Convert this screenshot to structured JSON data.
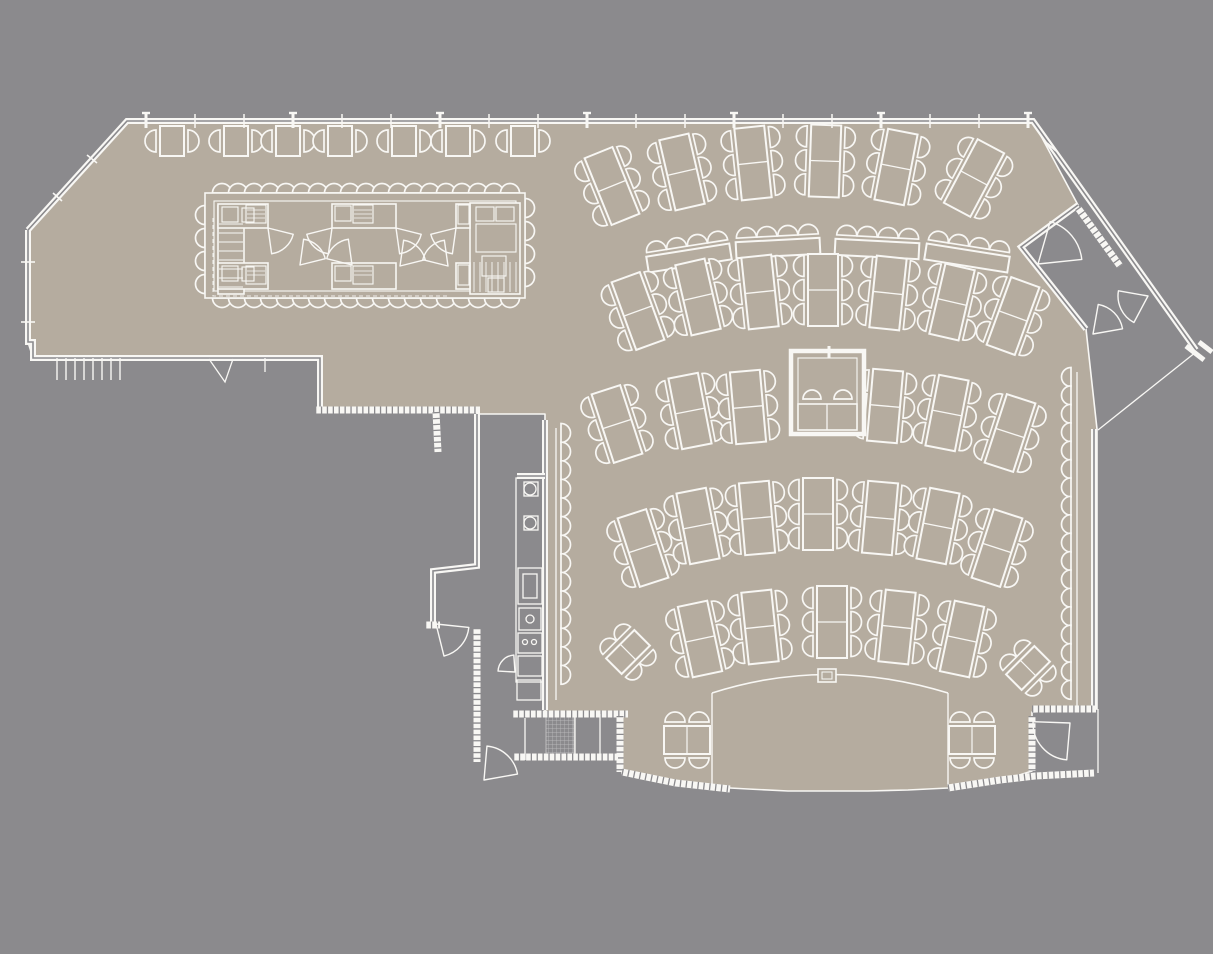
{
  "meta": {
    "type": "architectural-floor-plan",
    "description": "restaurant banquet floor plan, white linework on gray with taupe floor"
  },
  "colors": {
    "background": "#8b8a8d",
    "floor": "#b5ac9f",
    "line": "#f8f7f4",
    "line_soft": "#eeede9"
  },
  "canvas": {
    "width": 1213,
    "height": 954
  },
  "floor_outline": [
    [
      127,
      121
    ],
    [
      1033,
      121
    ],
    [
      1078,
      205
    ],
    [
      1021,
      247
    ],
    [
      1086,
      329
    ],
    [
      1097,
      429
    ],
    [
      1097,
      709
    ],
    [
      1032,
      712
    ],
    [
      1032,
      771
    ],
    [
      1010,
      778
    ],
    [
      980,
      784
    ],
    [
      948,
      788
    ],
    [
      908,
      790
    ],
    [
      868,
      791
    ],
    [
      827,
      791
    ],
    [
      788,
      791
    ],
    [
      748,
      789
    ],
    [
      712,
      787
    ],
    [
      678,
      783
    ],
    [
      648,
      779
    ],
    [
      622,
      774
    ],
    [
      622,
      712
    ],
    [
      545,
      712
    ],
    [
      545,
      414
    ],
    [
      477,
      414
    ],
    [
      477,
      410
    ],
    [
      320,
      409
    ],
    [
      320,
      358
    ],
    [
      33,
      358
    ],
    [
      28,
      342
    ],
    [
      28,
      230
    ]
  ],
  "walls": {
    "double": [
      [
        [
          28,
          230
        ],
        [
          127,
          121
        ],
        [
          1033,
          121
        ],
        [
          1196,
          350
        ]
      ],
      [
        [
          28,
          230
        ],
        [
          28,
          342
        ],
        [
          33,
          342
        ],
        [
          33,
          358
        ],
        [
          320,
          358
        ],
        [
          320,
          409
        ]
      ],
      [
        [
          477,
          414
        ],
        [
          477,
          566
        ],
        [
          433,
          571
        ],
        [
          433,
          622
        ]
      ],
      [
        [
          545,
          420
        ],
        [
          545,
          710
        ]
      ],
      [
        [
          1094,
          429
        ],
        [
          1094,
          709
        ]
      ],
      [
        [
          1078,
          205
        ],
        [
          1021,
          247
        ],
        [
          1086,
          329
        ]
      ],
      [
        [
          517,
          476
        ],
        [
          545,
          476
        ]
      ]
    ],
    "hatched": [
      [
        [
          315,
          410
        ],
        [
          480,
          410
        ]
      ],
      [
        [
          436,
          412
        ],
        [
          438,
          452
        ]
      ],
      [
        [
          477,
          628
        ],
        [
          477,
          762
        ]
      ],
      [
        [
          425,
          625
        ],
        [
          440,
          625
        ]
      ],
      [
        [
          512,
          714
        ],
        [
          628,
          714
        ]
      ],
      [
        [
          620,
          716
        ],
        [
          620,
          772
        ]
      ],
      [
        [
          622,
          772
        ],
        [
          676,
          783
        ],
        [
          730,
          789
        ]
      ],
      [
        [
          948,
          788
        ],
        [
          1000,
          780
        ],
        [
          1035,
          776
        ],
        [
          1094,
          773
        ]
      ],
      [
        [
          1032,
          709
        ],
        [
          1096,
          709
        ]
      ],
      [
        [
          1032,
          716
        ],
        [
          1032,
          771
        ]
      ],
      [
        [
          513,
          757
        ],
        [
          618,
          757
        ]
      ],
      [
        [
          1078,
          208
        ],
        [
          1120,
          266
        ]
      ]
    ],
    "thin": [
      [
        [
          1196,
          352
        ],
        [
          1098,
          430
        ]
      ],
      [
        [
          556,
          428
        ],
        [
          556,
          700
        ]
      ],
      [
        [
          1077,
          372
        ],
        [
          1077,
          706
        ]
      ],
      [
        [
          1098,
          709
        ],
        [
          1098,
          773
        ]
      ],
      [
        [
          525,
          718
        ],
        [
          525,
          760
        ]
      ],
      [
        [
          575,
          714
        ],
        [
          575,
          760
        ]
      ],
      [
        [
          600,
          714
        ],
        [
          600,
          760
        ]
      ],
      [
        [
          209,
          359
        ],
        [
          225,
          382
        ],
        [
          233,
          359
        ]
      ],
      [
        [
          265,
          358
        ],
        [
          265,
          372
        ]
      ]
    ]
  },
  "windows": {
    "top_ticks": {
      "y": 121,
      "x_start": 146,
      "step": 49,
      "count": 19,
      "major_every": 3
    },
    "seg_ticks": [
      [
        87,
        155,
        97,
        163
      ],
      [
        53,
        193,
        62,
        201
      ],
      [
        1047,
        143,
        1056,
        151
      ],
      [
        21,
        262,
        35,
        262
      ],
      [
        21,
        322,
        35,
        322
      ]
    ],
    "comb": {
      "x_start": 57,
      "step": 9,
      "count": 8,
      "y1": 358,
      "y2": 380
    }
  },
  "island": {
    "outer": [
      205,
      193,
      320,
      105
    ],
    "inner": [
      214,
      201,
      302,
      90
    ],
    "left_block": [
      218,
      206,
      26,
      88
    ],
    "right_block": [
      470,
      203,
      50,
      91
    ],
    "top_band": [
      [
        218,
        204,
        50,
        24
      ],
      [
        332,
        204,
        64,
        24
      ],
      [
        456,
        204,
        14,
        24
      ]
    ],
    "bottom_band": [
      [
        218,
        263,
        50,
        26
      ],
      [
        332,
        263,
        64,
        26
      ],
      [
        456,
        263,
        14,
        26
      ]
    ],
    "equip": [
      [
        222,
        207,
        16,
        15
      ],
      [
        242,
        208,
        12,
        14
      ],
      [
        246,
        205,
        20,
        18
      ],
      [
        335,
        206,
        16,
        15
      ],
      [
        353,
        205,
        20,
        18
      ],
      [
        458,
        205,
        11,
        19
      ],
      [
        222,
        266,
        16,
        15
      ],
      [
        242,
        267,
        12,
        14
      ],
      [
        246,
        266,
        20,
        18
      ],
      [
        335,
        266,
        16,
        15
      ],
      [
        353,
        266,
        20,
        18
      ],
      [
        458,
        265,
        11,
        20
      ],
      [
        476,
        207,
        18,
        14
      ],
      [
        496,
        207,
        18,
        14
      ],
      [
        476,
        224,
        40,
        28
      ],
      [
        482,
        256,
        24,
        20
      ],
      [
        488,
        278,
        16,
        14
      ]
    ],
    "equip_lines": [
      [
        247,
        210,
        265,
        210
      ],
      [
        247,
        214,
        265,
        214
      ],
      [
        247,
        218,
        265,
        218
      ],
      [
        354,
        210,
        372,
        210
      ],
      [
        354,
        214,
        372,
        214
      ],
      [
        354,
        218,
        372,
        218
      ],
      [
        247,
        271,
        265,
        271
      ],
      [
        247,
        275,
        265,
        275
      ],
      [
        354,
        271,
        372,
        271
      ],
      [
        354,
        275,
        372,
        275
      ]
    ],
    "shelf_left": {
      "x1": 219,
      "x2": 243,
      "y_start": 224,
      "step": 9,
      "count": 8
    },
    "shelf_right": {
      "y1": 262,
      "y2": 292,
      "x_start": 474,
      "step": 6,
      "count": 8
    },
    "stools": {
      "top": {
        "y": 193,
        "x_start": 222,
        "step": 16,
        "count": 19,
        "dir": "up"
      },
      "bottom": {
        "y": 298,
        "x_start": 222,
        "step": 16,
        "count": 19,
        "dir": "down"
      },
      "left": {
        "x": 205,
        "ys": [
          215,
          238,
          261,
          284
        ],
        "dir": "left"
      },
      "right": {
        "x": 525,
        "ys": [
          208,
          231,
          254,
          277
        ],
        "dir": "right"
      }
    },
    "dashed": [
      [
        213,
        218
      ],
      [
        213,
        296
      ],
      [
        448,
        296
      ]
    ],
    "fans": [
      [
        268,
        228,
        26,
        14,
        82
      ],
      [
        332,
        228,
        26,
        98,
        166
      ],
      [
        300,
        265,
        26,
        -82,
        -14
      ],
      [
        352,
        265,
        26,
        194,
        262
      ],
      [
        396,
        228,
        26,
        14,
        82
      ],
      [
        456,
        228,
        26,
        98,
        166
      ],
      [
        400,
        266,
        26,
        -82,
        -14
      ],
      [
        448,
        266,
        26,
        194,
        262
      ]
    ]
  },
  "corridor": {
    "column": [
      516,
      478,
      28,
      204
    ],
    "circles": [
      [
        530,
        489,
        6
      ],
      [
        530,
        523,
        6
      ],
      [
        530,
        619,
        4
      ],
      [
        525,
        642,
        2.5
      ],
      [
        534,
        642,
        2.5
      ]
    ],
    "rects": [
      [
        524,
        482,
        14,
        14
      ],
      [
        524,
        516,
        14,
        14
      ],
      [
        518,
        568,
        24,
        36
      ],
      [
        523,
        574,
        14,
        24
      ],
      [
        519,
        608,
        22,
        22
      ],
      [
        518,
        633,
        24,
        20
      ],
      [
        518,
        656,
        24,
        20
      ],
      [
        517,
        680,
        24,
        20
      ]
    ],
    "hatch_fill": [
      546,
      714,
      28,
      45
    ]
  },
  "rails": {
    "left": {
      "x": 561,
      "y0": 433,
      "step": 18.6,
      "count": 14,
      "dir": "right"
    },
    "right": {
      "x": 1071,
      "y0": 377,
      "step": 18.4,
      "count": 18,
      "dir": "left"
    }
  },
  "table_groups": [
    {
      "name": "window-row",
      "type": "t2",
      "items": [
        [
          172,
          141,
          0
        ],
        [
          236,
          141,
          0
        ],
        [
          288,
          141,
          0
        ],
        [
          340,
          141,
          0
        ],
        [
          404,
          141,
          0
        ],
        [
          458,
          141,
          0
        ],
        [
          523,
          141,
          0
        ]
      ]
    },
    {
      "name": "row-1",
      "type": "t6",
      "items": [
        [
          612,
          186,
          -22
        ],
        [
          682,
          172,
          -13
        ],
        [
          753,
          163,
          -6
        ],
        [
          825,
          161,
          2
        ],
        [
          896,
          167,
          11
        ],
        [
          974,
          178,
          28
        ]
      ]
    },
    {
      "name": "serving-row",
      "type": "long",
      "items": [
        [
          689,
          258,
          -9
        ],
        [
          778,
          248,
          -3
        ],
        [
          877,
          249,
          3
        ],
        [
          967,
          258,
          9
        ]
      ]
    },
    {
      "name": "row-2",
      "type": "t6",
      "items": [
        [
          638,
          311,
          -20
        ],
        [
          698,
          297,
          -13
        ],
        [
          760,
          292,
          -6
        ],
        [
          823,
          290,
          0
        ],
        [
          888,
          293,
          6
        ],
        [
          952,
          302,
          13
        ],
        [
          1013,
          316,
          20
        ]
      ]
    },
    {
      "name": "row-3",
      "type": "t6",
      "items": [
        [
          617,
          424,
          -18
        ],
        [
          690,
          411,
          -11
        ],
        [
          748,
          407,
          -5
        ],
        [
          885,
          406,
          5
        ],
        [
          947,
          413,
          11
        ],
        [
          1010,
          433,
          18
        ]
      ]
    },
    {
      "name": "row-4",
      "type": "t6",
      "items": [
        [
          643,
          548,
          -18
        ],
        [
          698,
          526,
          -11
        ],
        [
          757,
          518,
          -5
        ],
        [
          818,
          514,
          0
        ],
        [
          880,
          518,
          5
        ],
        [
          938,
          526,
          11
        ],
        [
          997,
          548,
          18
        ]
      ]
    },
    {
      "name": "row-5",
      "type": "t6",
      "items": [
        [
          700,
          639,
          -12
        ],
        [
          760,
          627,
          -6
        ],
        [
          832,
          622,
          0
        ],
        [
          897,
          627,
          6
        ],
        [
          962,
          639,
          12
        ]
      ]
    },
    {
      "name": "corner-diamonds",
      "type": "diamond",
      "items": [
        [
          628,
          652,
          45
        ],
        [
          1028,
          668,
          45
        ]
      ]
    },
    {
      "name": "stage-side",
      "type": "sq4",
      "items": [
        [
          687,
          740,
          0
        ],
        [
          972,
          740,
          0
        ]
      ]
    }
  ],
  "booth": {
    "outer": [
      791,
      351,
      73,
      83
    ],
    "inner": [
      798,
      358,
      59,
      69
    ],
    "counter": [
      798,
      404,
      59,
      26
    ],
    "divider_x": 827,
    "chairs": [
      [
        812,
        399
      ],
      [
        843,
        399
      ]
    ],
    "tick": [
      829,
      346,
      829,
      358
    ]
  },
  "stage": {
    "arc": [
      712,
      693,
      827,
      656,
      948,
      693
    ],
    "left_wall": [
      712,
      693,
      712,
      787
    ],
    "right_wall": [
      948,
      693,
      948,
      786
    ],
    "podium": [
      818,
      669,
      18,
      13
    ],
    "podium_inner": [
      822,
      672,
      10,
      7
    ]
  },
  "doors": [
    [
      436,
      624,
      33,
      6,
      76
    ],
    [
      484,
      780,
      34,
      -85,
      -10
    ],
    [
      515,
      672,
      17,
      183,
      266
    ],
    [
      1070,
      723,
      37,
      95,
      182
    ],
    [
      1038,
      264,
      44,
      -74,
      -6
    ],
    [
      1093,
      334,
      30,
      -80,
      -10
    ],
    [
      1148,
      296,
      30,
      118,
      190
    ]
  ],
  "vestibule": {
    "endcap": [
      [
        1186,
        346,
        1204,
        360
      ],
      [
        1199,
        342,
        1212,
        352
      ]
    ]
  }
}
